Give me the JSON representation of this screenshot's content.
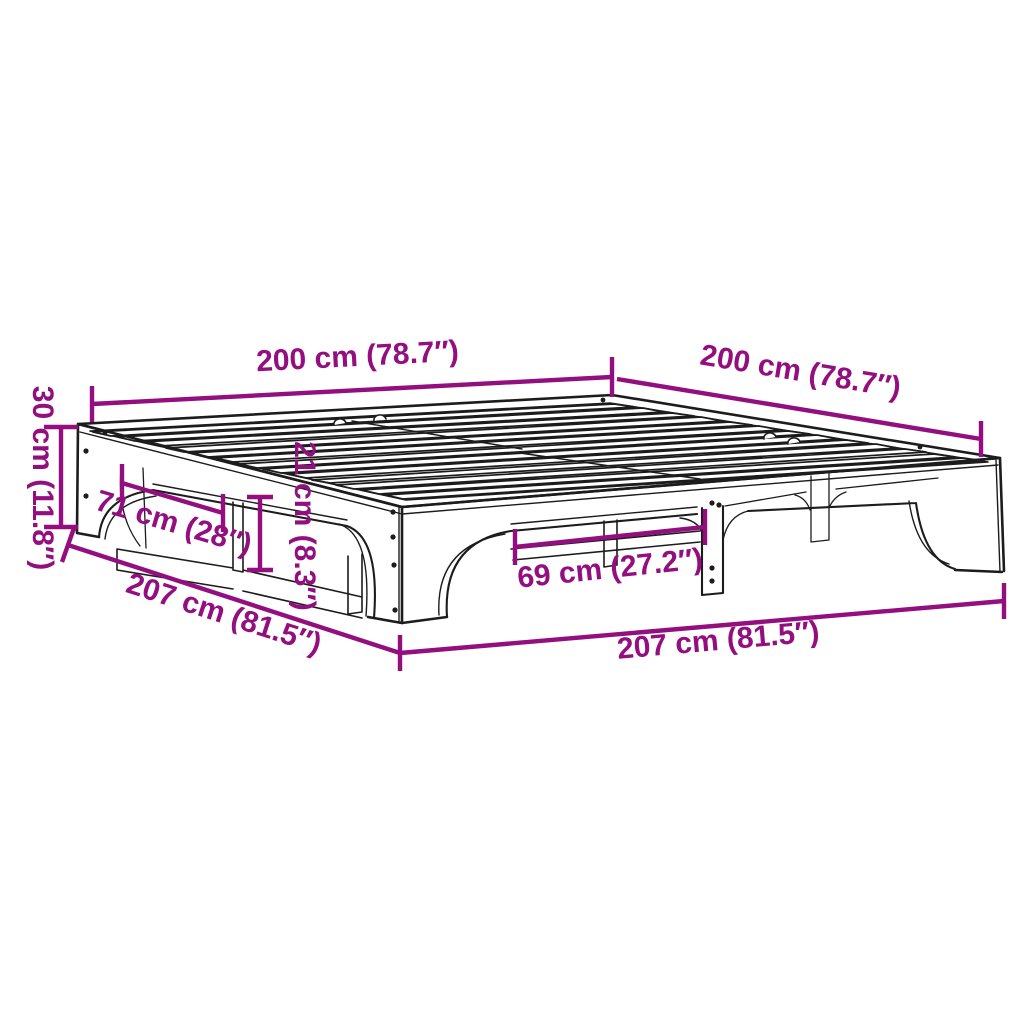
{
  "diagram": {
    "type": "product-dimension-diagram",
    "subject": "bed-frame-with-slats",
    "colors": {
      "dimension_accent": "#930E7E",
      "line_art": "#1c1c1c",
      "background": "#ffffff"
    },
    "dimensions": {
      "top_left_width": "200 cm (78.7″)",
      "top_right_depth": "200 cm (78.7″)",
      "left_height": "30 cm (11.8″)",
      "left_leg_spacing": "71 cm (28″)",
      "under_clearance": "21 cm (8.3″)",
      "front_leg_spacing": "69 cm (27.2″)",
      "bottom_left_length": "207 cm (81.5″)",
      "bottom_right_length": "207 cm (81.5″)"
    }
  }
}
